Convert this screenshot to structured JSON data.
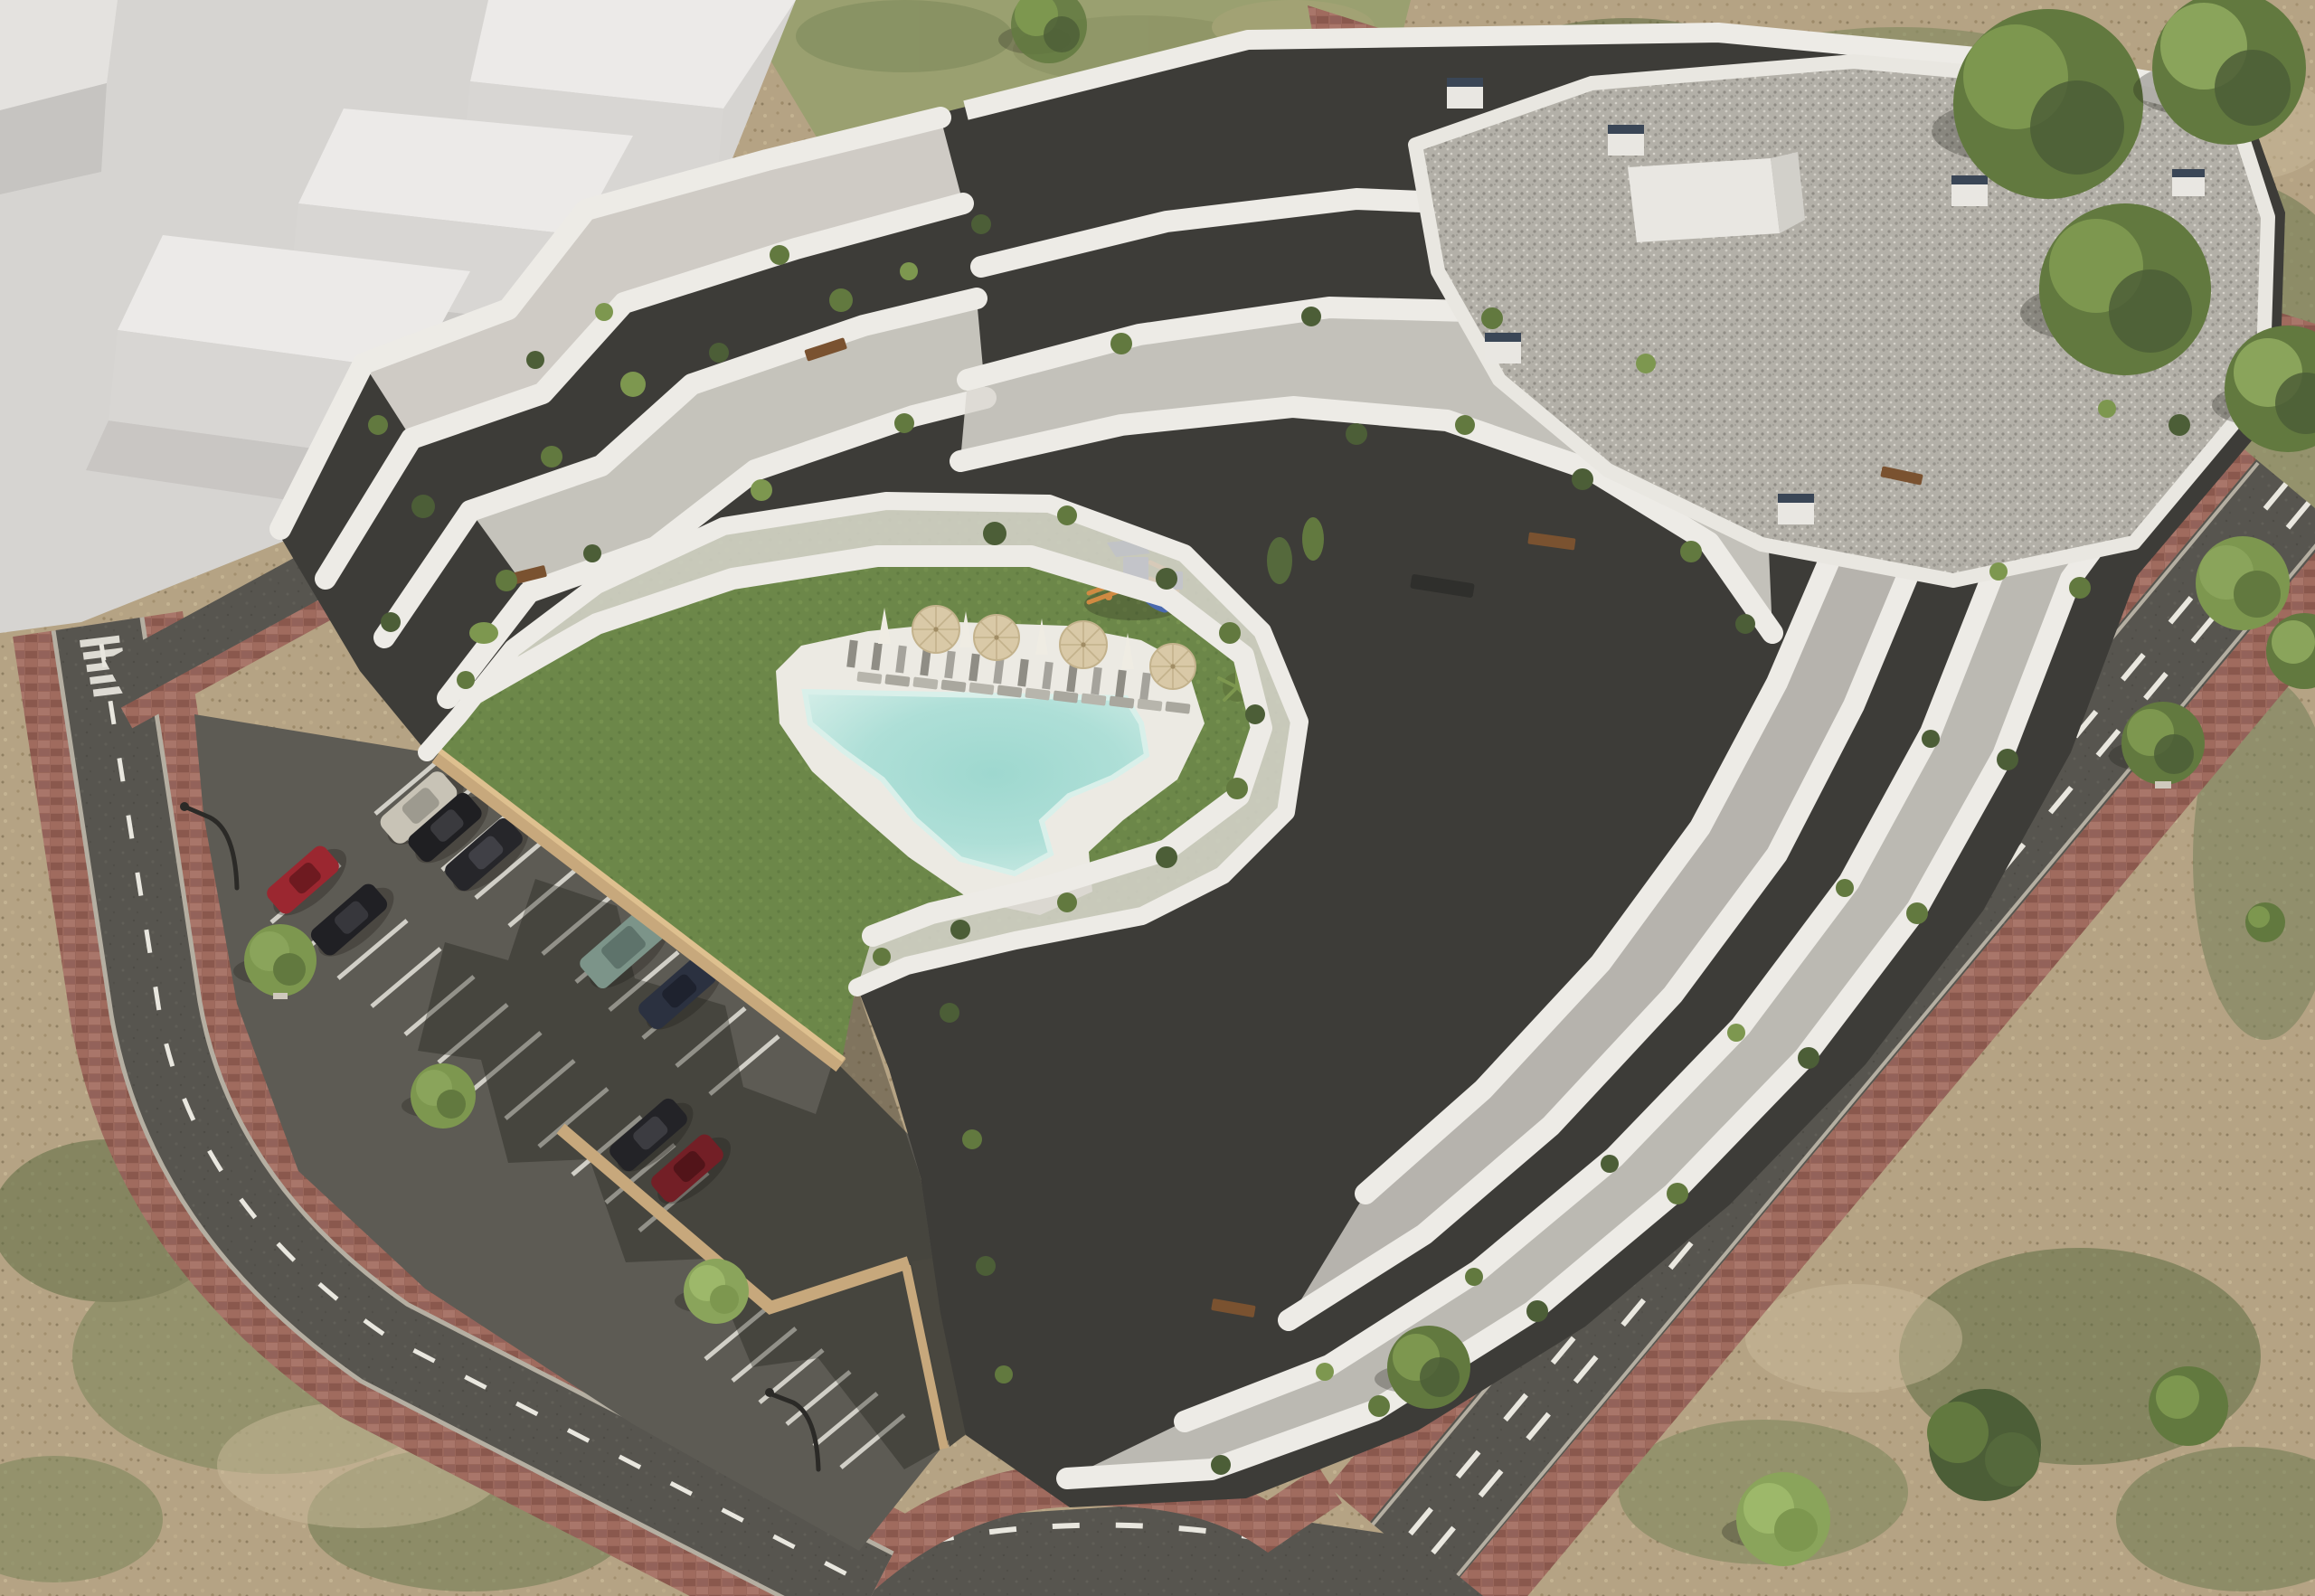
{
  "scene": {
    "title": "Aerial architectural rendering",
    "description": "Aerial 3D architectural rendering of a modern white terraced apartment complex with a landscaped courtyard containing a lawn, free-form swimming pool, sun loungers, parasols and a children's playground; a surface parking lot with parked cars; perimeter roads with dashed lane markings and brick-paver sidewalks; ghosted white massing blocks of neighbouring buildings at the top left; dry patchy dirt terrain with trees around the site."
  },
  "colors": {
    "dirt": "#b5a384",
    "dirt_light": "#c9ba9a",
    "dirt_dark": "#a08d6e",
    "grass_patch": "#78855a",
    "grass_patch_dark": "#5d6e44",
    "field": "#9aa070",
    "lawn": "#6c8749",
    "lawn_light": "#7a9553",
    "pool_water": "#aedfd7",
    "pool_deep": "#8fd0c7",
    "pool_edge": "#d9f0ea",
    "pool_deck": "#eceae3",
    "deck_plank": "#8f8d85",
    "asphalt": "#57554f",
    "parking_asphalt": "#5d5b54",
    "driveway": "#49473f",
    "road_dash": "#e9e7df",
    "sidewalk_brick": "#9a675b",
    "sidewalk_brick_dark": "#8a584d",
    "sidewalk_brick_light": "#ab7668",
    "curb": "#b5afa2",
    "building_white": "#edebe6",
    "terrace_floor": "#dbd8d1",
    "window_band": "#3d3c38",
    "roof_gravel": "#b3b0a8",
    "roof_parapet": "#e9e7e1",
    "vent_cap": "#3a4656",
    "retaining_wall": "#c7a87c",
    "retaining_wall_light": "#dec08f",
    "massing_plane": "#d6d4d1",
    "massing_top": "#eceae8",
    "massing_front": "#d8d6d3",
    "massing_side": "#c6c4c1",
    "tree_dark": "#4c5e37",
    "tree_mid": "#62793f",
    "tree_light": "#7d974f",
    "bush_light": "#8aa45b",
    "umbrella_canvas": "#d9c9a7",
    "umbrella_white": "#efece3",
    "playground_blue": "#4a69ae",
    "playground_blue_dark": "#3f5c9d",
    "playground_orange": "#d08a42",
    "lounger": "#b7b5ac",
    "table_wood": "#7a5230",
    "lamp_pole": "#2b2a27",
    "shadow": "rgba(30,28,23,0.35)"
  },
  "site": {
    "courtyard": {
      "has_lawn": true,
      "has_pool": true,
      "pool_shape": "free-form wedge",
      "open_parasol_count": 4,
      "folded_parasol_count": 4,
      "poolside_lounger_count": 12,
      "playground_count": 1,
      "stepping_plank_path": true
    },
    "parking": {
      "stall_line_color": "#e6e4dc",
      "street_lamp_count": 2,
      "cars": [
        {
          "name": "silver-coupe",
          "color": "#c8c3b6"
        },
        {
          "name": "black-hatchback",
          "color": "#1f1f22"
        },
        {
          "name": "black-sedan",
          "color": "#26262a"
        },
        {
          "name": "red-hatchback",
          "color": "#9b2730"
        },
        {
          "name": "black-sedan-2",
          "color": "#202024"
        },
        {
          "name": "teal-suv",
          "color": "#7c9489"
        },
        {
          "name": "navy-sedan",
          "color": "#2b3140"
        },
        {
          "name": "black-sedan-3",
          "color": "#232327"
        },
        {
          "name": "dark-red-hatchback",
          "color": "#731f26"
        }
      ]
    },
    "building": {
      "style": "stepped white terraces with dark glazing bands and planted balconies",
      "roof": "grey gravel with white parapet",
      "roof_vent_count": 7,
      "has_crosswalk": true
    }
  }
}
